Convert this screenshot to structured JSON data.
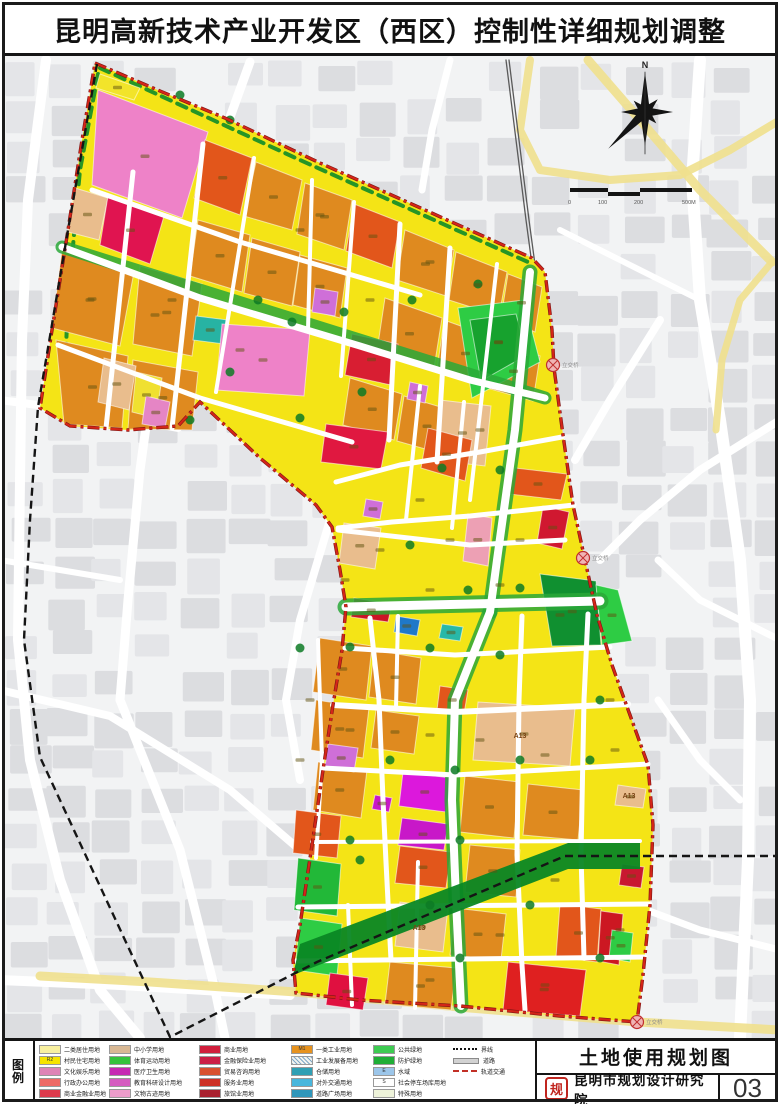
{
  "page": {
    "title": "昆明高新技术产业开发区（西区）控制性详细规划调整"
  },
  "legend": {
    "heading": "图例",
    "columns": [
      {
        "left": 34,
        "items": [
          {
            "color": "#f8f0a0",
            "label": "二类居住用地"
          },
          {
            "color": "#f6e400",
            "label": "村民住宅用地",
            "code": "R2"
          },
          {
            "color": "#de84b6",
            "label": "文化娱乐用地"
          },
          {
            "color": "#ee6a66",
            "label": "行政办公用地"
          },
          {
            "color": "#dd3a4c",
            "label": "商业金融业用地"
          }
        ]
      },
      {
        "left": 104,
        "items": [
          {
            "color": "#d8b894",
            "label": "中小学用地"
          },
          {
            "color": "#35c33c",
            "label": "体育运动用地"
          },
          {
            "color": "#c629b3",
            "label": "医疗卫生用地"
          },
          {
            "color": "#d55cc0",
            "label": "教育科研设计用地"
          },
          {
            "color": "#ec9ccb",
            "label": "文物古迹用地"
          }
        ]
      },
      {
        "left": 194,
        "items": [
          {
            "color": "#d01f3c",
            "label": "商业用地"
          },
          {
            "color": "#cb1f46",
            "label": "金融保险业用地"
          },
          {
            "color": "#d8512e",
            "label": "贸易咨询用地"
          },
          {
            "color": "#cd3126",
            "label": "服务业用地"
          },
          {
            "color": "#a9202e",
            "label": "旅馆业用地"
          }
        ]
      },
      {
        "left": 286,
        "items": [
          {
            "color": "#e6921e",
            "label": "一类工业用地",
            "code": "M1"
          },
          {
            "color": "#f4f4f0",
            "label": "工业发展备用地",
            "hatched": true
          },
          {
            "color": "#2f9fb4",
            "label": "仓储用地"
          },
          {
            "color": "#49b6dc",
            "label": "对外交通用地"
          },
          {
            "color": "#2f96ba",
            "label": "道路广场用地"
          }
        ]
      },
      {
        "left": 368,
        "items": [
          {
            "color": "#3ecb52",
            "label": "公共绿地"
          },
          {
            "color": "#1fae36",
            "label": "防护绿地"
          },
          {
            "color": "#9cc6ea",
            "label": "水域",
            "code": "E"
          },
          {
            "color": "#ffffff",
            "label": "社会停车场库用地",
            "code": "S"
          },
          {
            "color": "#eef3da",
            "label": "特殊用地"
          }
        ]
      }
    ],
    "line_items": {
      "left": 448,
      "items": [
        {
          "style": "dotted",
          "label": "界线"
        },
        {
          "style": "bar",
          "label": "道路"
        },
        {
          "style": "reddash",
          "label": "轨道交通"
        }
      ]
    }
  },
  "title_block": {
    "map_name": "土地使用规划图",
    "institute": "昆明市规划设计研究院",
    "sheet_no": "03",
    "logo_glyph": "规"
  },
  "map": {
    "compass_label": "N",
    "scale_labels": [
      "0",
      "100",
      "200",
      "500M"
    ],
    "interchange_label": "立交桥",
    "markers": [
      [
        553,
        365
      ],
      [
        583,
        558
      ],
      [
        637,
        1022
      ]
    ],
    "parcel_labels": [
      [
        520,
        738,
        "A13"
      ],
      [
        419,
        930,
        "A13"
      ],
      [
        629,
        798,
        "A13"
      ]
    ],
    "colors": {
      "area_base": "#f4e416",
      "road": "#ffffff",
      "green_road": "#2aa838",
      "gray_block": "#e4e5e8",
      "gray_block2": "#dcdde0",
      "yellow_road": "#efe08d",
      "boundary": "#d42518",
      "boundary_casing": "#7a1414",
      "admin": "#151515",
      "rail_band": "#0a8724",
      "blob": "#0d7a24",
      "smudge": "#5f5210"
    },
    "outline": "95,63 160,91 225,118 320,163 425,210 532,258 545,272 552,330 554,368 563,435 573,505 585,560 597,615 612,665 630,715 648,765 653,825 650,905 643,975 637,1022 560,1016 460,1006 360,1000 296,993 293,960 300,925 312,845 323,770 333,705 342,650 346,607 340,570 332,527 316,505 260,458 200,402 178,426 128,430 70,426 40,408 52,330 68,230 82,140",
    "admin_line": "97,64 68,230 38,407 30,520 24,640 40,757 170,1037 317,962 565,856 778,856",
    "rail_line": "506,60 516,140 526,220 533,272",
    "rail_band": "640,843 568,843 300,944 293,975 568,869 640,869",
    "green_edges": [
      "98,74 80,170 68,300 64,395",
      "100,68 300,160 528,262"
    ],
    "base_roads": [
      [
        "46,60 28,200 22,340 20,480 18,640 30,760 60,880 100,990 140,1038",
        10
      ],
      [
        "250,62 200,200 158,340 140,470 128,600 120,700",
        9
      ],
      [
        "0,400 90,412 178,428",
        8
      ],
      [
        "120,700 180,850 215,990 225,1038",
        9
      ],
      [
        "0,690 110,716 230,790 300,850",
        8
      ],
      [
        "330,520 300,620 286,700 300,780",
        8
      ],
      [
        "0,980 120,985 290,995",
        10
      ],
      [
        "700,60 692,180 700,300 720,420 740,560 750,700 748,860 740,1038",
        12
      ],
      [
        "660,320 610,400 575,460",
        8
      ],
      [
        "780,420 700,470 640,520 600,560",
        8
      ],
      [
        "658,700 700,760 740,800",
        7
      ],
      [
        "620,900 700,930 780,950",
        7
      ],
      [
        "658,560 700,600 780,640",
        7
      ],
      [
        "450,60 432,130 422,190",
        7
      ],
      [
        "560,230 620,260 700,300",
        6
      ],
      [
        "0,560 60,570 120,580",
        6
      ]
    ],
    "yellow_roads": [
      [
        "588,60 640,120 700,190 772,262",
        9
      ],
      [
        "530,60 520,130 540,170 610,180 680,175 730,150 780,120",
        8
      ],
      [
        "772,262 740,300 722,360 716,430",
        7
      ],
      [
        "40,976 150,982 296,992",
        9
      ],
      [
        "296,992 470,1008 637,1022 780,1030",
        9
      ]
    ],
    "green_roads": [
      [
        "530,272 515,430 497,560 490,612",
        15
      ],
      [
        "346,607 600,601",
        17
      ],
      [
        "490,612 455,700 452,800 456,900 461,1006",
        15
      ],
      [
        "62,247 545,398",
        13
      ]
    ],
    "roads": [
      [
        "62,247 200,298 360,346 470,380 545,398",
        7
      ],
      [
        "92,190 240,242 420,295",
        5
      ],
      [
        "58,345 200,398 352,442",
        5
      ],
      [
        "133,172 106,428",
        5
      ],
      [
        "203,144 172,428",
        5
      ],
      [
        "254,158 216,392",
        4
      ],
      [
        "312,180 308,330",
        4
      ],
      [
        "354,202 341,376",
        4
      ],
      [
        "400,224 389,440",
        5
      ],
      [
        "450,248 437,462",
        5
      ],
      [
        "497,264 470,500",
        4
      ],
      [
        "530,272 515,430 497,560 490,612",
        8
      ],
      [
        "338,530 470,545 565,540",
        5
      ],
      [
        "346,607 600,601",
        9
      ],
      [
        "562,437 480,452 400,465 336,482",
        5
      ],
      [
        "574,505 470,516 392,522 338,528",
        5
      ],
      [
        "420,386 406,520",
        4
      ],
      [
        "464,402 452,528",
        4
      ],
      [
        "490,612 455,700 452,800 456,900 461,1006",
        8
      ],
      [
        "370,618 379,700 383,800 386,862 391,960",
        5
      ],
      [
        "318,640 322,760 316,858",
        4
      ],
      [
        "522,616 519,700 517,855 522,965 525,1010",
        5
      ],
      [
        "588,614 584,700 581,855 584,958",
        5
      ],
      [
        "345,648 455,655 610,647",
        5
      ],
      [
        "333,705 455,712 628,704",
        6
      ],
      [
        "323,768 455,775 648,764",
        5
      ],
      [
        "312,842 640,841",
        4
      ],
      [
        "298,907 650,904",
        5
      ],
      [
        "295,961 645,957",
        5
      ],
      [
        "348,905 352,1005",
        4
      ],
      [
        "418,862 415,1008",
        4
      ],
      [
        "398,616 396,708",
        4
      ]
    ],
    "parcels": [
      [
        "98,90 208,132 182,218 92,185",
        "#ee82c8"
      ],
      [
        "100,74 140,88 134,100 96,88",
        "#f2e42a"
      ],
      [
        "75,188 108,198 99,240 68,232",
        "#e9bd8d"
      ],
      [
        "108,196 164,216 150,264 100,245",
        "#e01450"
      ],
      [
        "62,250 134,272 120,346 52,328",
        "#df8a1f"
      ],
      [
        "56,340 128,356 122,428 64,424",
        "#df8a1f"
      ],
      [
        "133,360 198,372 192,430 128,429",
        "#df8a1f"
      ],
      [
        "140,266 202,284 192,356 133,344",
        "#df8a1f"
      ],
      [
        "104,358 136,366 129,410 98,402",
        "#e9bd8d"
      ],
      [
        "136,372 162,378 156,418 132,412",
        "#f0e030"
      ],
      [
        "146,396 170,402 165,428 142,424",
        "#e585c5"
      ],
      [
        "205,140 252,158 240,215 194,198",
        "#e2561b"
      ],
      [
        "256,162 302,180 292,230 244,216",
        "#df8a1f"
      ],
      [
        "198,220 250,235 242,292 190,276",
        "#df8a1f"
      ],
      [
        "252,238 300,252 292,306 244,293",
        "#df8a1f"
      ],
      [
        "305,183 352,200 344,250 297,234",
        "#df8a1f"
      ],
      [
        "354,204 400,222 392,268 346,251",
        "#e2561b"
      ],
      [
        "300,255 347,268 340,318 293,305",
        "#df8a1f"
      ],
      [
        "405,230 454,250 446,296 397,280",
        "#df8a1f"
      ],
      [
        "456,252 507,272 499,316 449,300",
        "#df8a1f"
      ],
      [
        "508,274 542,287 535,332 501,318",
        "#df8a1f"
      ],
      [
        "385,298 442,318 434,368 377,351",
        "#df8a1f"
      ],
      [
        "444,320 494,338 487,386 437,370",
        "#df8a1f"
      ],
      [
        "494,340 540,356 533,401 487,388",
        "#df8a1f"
      ],
      [
        "350,378 402,394 394,440 343,425",
        "#df8a1f"
      ],
      [
        "404,396 457,412 450,456 397,441",
        "#df8a1f"
      ],
      [
        "196,316 228,320 224,344 193,340",
        "#27b3a3"
      ],
      [
        "222,324 310,330 304,396 216,390",
        "#ee82c8"
      ],
      [
        "315,288 338,292 335,316 312,312",
        "#cf6fd8"
      ],
      [
        "352,334 398,344 391,385 345,375",
        "#d81e32"
      ],
      [
        "458,308 524,300 540,362 472,398",
        "#2ecc44"
      ],
      [
        "470,320 516,314 527,355 481,381",
        "#17a22e"
      ],
      [
        "410,382 428,386 425,403 407,399",
        "#cf6fd8"
      ],
      [
        "440,400 491,406 485,466 434,460",
        "#e9bd8d"
      ],
      [
        "326,424 388,432 381,469 321,462",
        "#e01840"
      ],
      [
        "428,428 472,440 465,481 421,468",
        "#e2561b"
      ],
      [
        "515,468 567,474 561,500 509,494",
        "#e2561b"
      ],
      [
        "543,506 569,512 562,549 537,543",
        "#d01830"
      ],
      [
        "468,514 492,518 488,566 463,561",
        "#eda0b4"
      ],
      [
        "344,523 381,528 375,569 339,563",
        "#e9bd8d"
      ],
      [
        "366,499 383,502 380,519 363,516",
        "#cf6fd8"
      ],
      [
        "354,598 392,604 388,622 351,617",
        "#cc1426"
      ],
      [
        "540,574 596,581 601,645 552,646",
        "#109030"
      ],
      [
        "596,585 618,590 632,641 602,645",
        "#2ecc44"
      ],
      [
        "320,638 372,646 366,700 313,692",
        "#df8a1f"
      ],
      [
        "316,700 369,708 363,758 311,750",
        "#df8a1f"
      ],
      [
        "318,762 367,770 361,818 313,810",
        "#df8a1f"
      ],
      [
        "374,650 421,658 416,704 369,697",
        "#df8a1f"
      ],
      [
        "376,710 419,716 414,754 371,748",
        "#df8a1f"
      ],
      [
        "396,616 420,620 417,636 394,632",
        "#1f78c8"
      ],
      [
        "442,624 463,627 460,641 439,638",
        "#28b8a8"
      ],
      [
        "440,686 468,690 464,714 437,710",
        "#e2561b"
      ],
      [
        "328,744 358,748 354,772 325,768",
        "#cf6fd8"
      ],
      [
        "403,772 451,778 446,812 399,806",
        "#dc18dc"
      ],
      [
        "402,818 448,824 444,850 398,845",
        "#c818c8"
      ],
      [
        "375,795 392,798 389,812 372,809",
        "#c818c8"
      ],
      [
        "478,702 575,708 570,766 473,760",
        "#e9bd8d"
      ],
      [
        "465,776 519,782 514,838 460,832",
        "#df8a1f"
      ],
      [
        "528,784 583,790 578,840 523,835",
        "#df8a1f"
      ],
      [
        "400,846 451,852 446,888 395,883",
        "#e2561b"
      ],
      [
        "470,845 520,850 516,897 465,892",
        "#df8a1f"
      ],
      [
        "296,810 341,816 337,858 293,853",
        "#e2561b"
      ],
      [
        "298,858 341,864 337,916 294,910",
        "#22b838"
      ],
      [
        "300,918 342,924 337,976 295,970",
        "#2ecc44"
      ],
      [
        "330,973 368,978 363,1010 326,1005",
        "#e01040"
      ],
      [
        "390,962 456,968 451,1010 385,1004",
        "#df8a1f"
      ],
      [
        "400,902 448,908 443,952 395,946",
        "#e9bd8d"
      ],
      [
        "455,908 506,914 501,960 450,955",
        "#df8a1f"
      ],
      [
        "508,962 586,970 580,1016 503,1010",
        "#df2020"
      ],
      [
        "560,904 601,909 597,962 556,957",
        "#e2561b"
      ],
      [
        "601,911 623,914 619,965 598,961",
        "#cc1822"
      ],
      [
        "612,930 633,933 630,962 609,958",
        "#2ecc44"
      ],
      [
        "618,785 646,789 643,808 615,805",
        "#e9bd8d"
      ],
      [
        "622,864 644,867 641,888 619,885",
        "#c81830"
      ]
    ],
    "green_blobs": [
      [
        292,
        322
      ],
      [
        258,
        300
      ],
      [
        344,
        312
      ],
      [
        412,
        300
      ],
      [
        478,
        284
      ],
      [
        300,
        418
      ],
      [
        362,
        392
      ],
      [
        230,
        372
      ],
      [
        190,
        420
      ],
      [
        442,
        468
      ],
      [
        500,
        470
      ],
      [
        410,
        545
      ],
      [
        468,
        590
      ],
      [
        520,
        588
      ],
      [
        430,
        648
      ],
      [
        500,
        655
      ],
      [
        390,
        760
      ],
      [
        455,
        770
      ],
      [
        520,
        760
      ],
      [
        590,
        760
      ],
      [
        350,
        840
      ],
      [
        460,
        840
      ],
      [
        600,
        700
      ],
      [
        350,
        647
      ],
      [
        300,
        648
      ],
      [
        430,
        905
      ],
      [
        530,
        905
      ],
      [
        600,
        958
      ],
      [
        460,
        958
      ],
      [
        360,
        860
      ],
      [
        230,
        120
      ],
      [
        180,
        95
      ]
    ],
    "extra_label_dots": [
      [
        320,
        215
      ],
      [
        430,
        262
      ],
      [
        172,
        300
      ],
      [
        90,
        300
      ],
      [
        240,
        350
      ],
      [
        370,
        300
      ],
      [
        480,
        430
      ],
      [
        420,
        500
      ],
      [
        380,
        550
      ],
      [
        450,
        540
      ],
      [
        520,
        540
      ],
      [
        430,
        590
      ],
      [
        500,
        585
      ],
      [
        560,
        615
      ],
      [
        345,
        580
      ],
      [
        610,
        700
      ],
      [
        615,
        750
      ],
      [
        480,
        740
      ],
      [
        545,
        755
      ],
      [
        430,
        735
      ],
      [
        350,
        730
      ],
      [
        620,
        930
      ],
      [
        555,
        880
      ],
      [
        500,
        935
      ],
      [
        430,
        980
      ],
      [
        545,
        985
      ],
      [
        300,
        760
      ],
      [
        310,
        700
      ],
      [
        300,
        230
      ],
      [
        155,
        315
      ]
    ]
  }
}
